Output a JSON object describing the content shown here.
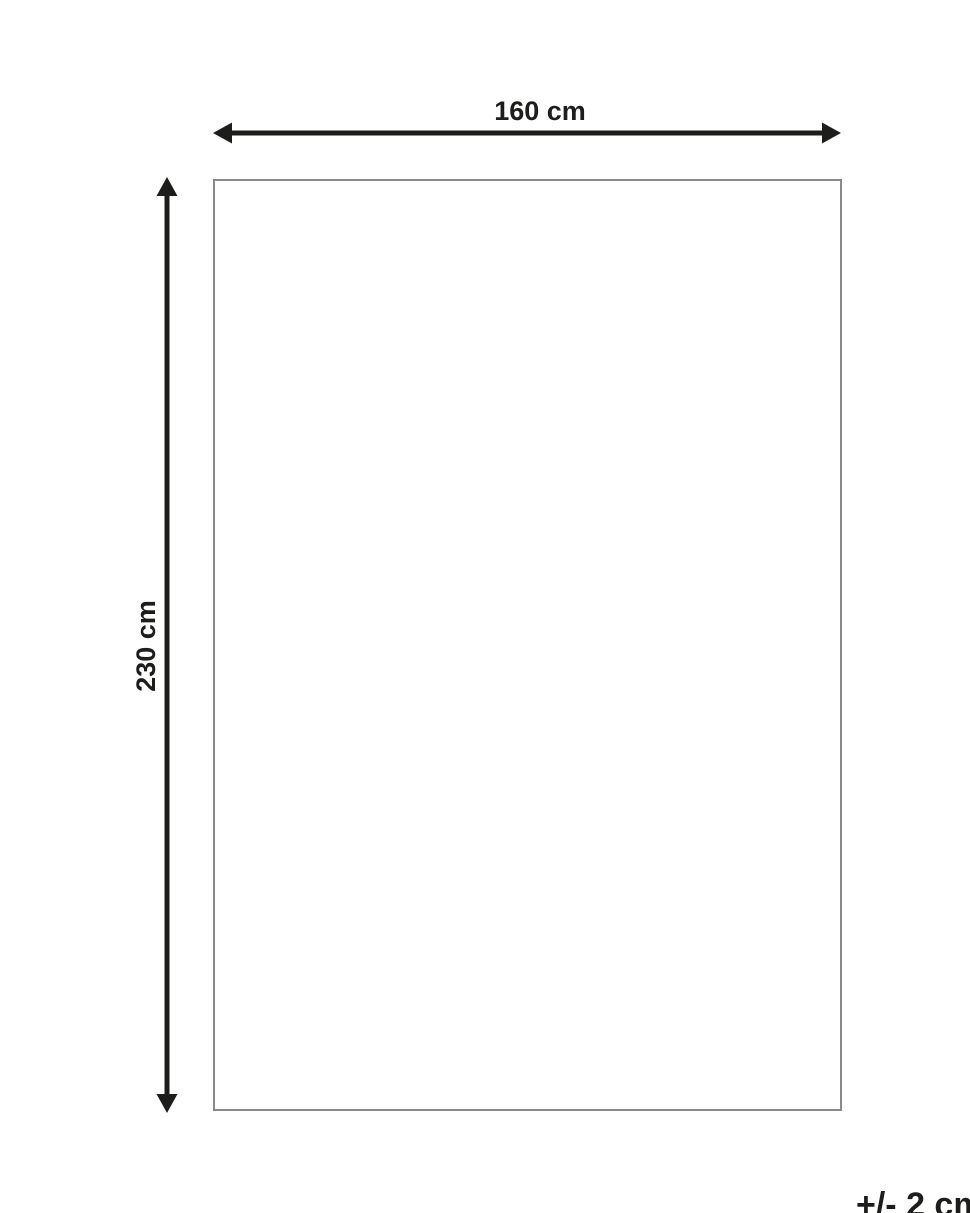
{
  "diagram": {
    "title": "product-dimension-diagram",
    "width_label": "160 cm",
    "height_label": "230 cm",
    "tolerance_label": "+/- 2 cm",
    "colors": {
      "arrow_and_text": "#1d1d1b",
      "rect_border": "#8a8a8a",
      "background": "#ffffff"
    }
  }
}
